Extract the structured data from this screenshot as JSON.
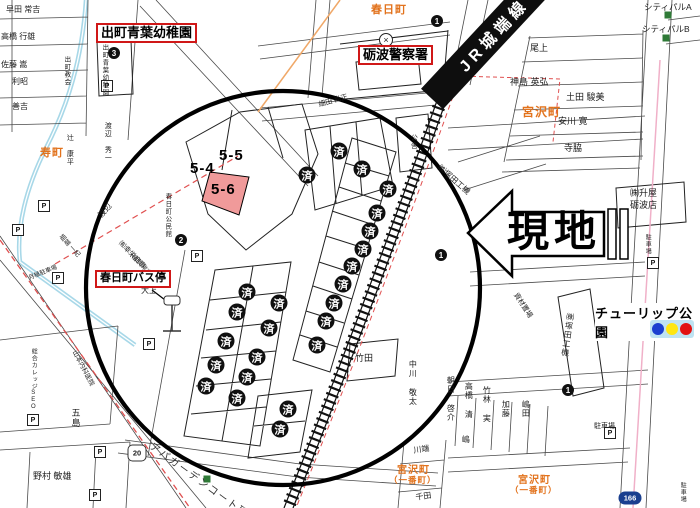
{
  "map": {
    "site_label": "現地",
    "railway_label": "JR城端線",
    "park_label": "チューリップ公園",
    "apartment_label": "アパガーデンコート砺波",
    "sold_label": "済",
    "police_symbol": "×",
    "parking_symbol": "P",
    "colors": {
      "red_box_border": "#d01818",
      "town_orange": "#e2721c",
      "pink_lot": "#f09a9a",
      "signal_bg": "#bfe3f2",
      "signal_lights": [
        "#1b3fd0",
        "#ffe612",
        "#e21212"
      ],
      "green_square": "#2f7a37",
      "canal_blue": "#a8d8e8",
      "route_dash_red": "#e05050"
    },
    "red_box_labels": [
      {
        "text": "出町青葉幼稚園",
        "x": 96,
        "y": 23,
        "fs": 13
      },
      {
        "text": "砺波警察署",
        "x": 358,
        "y": 45,
        "fs": 13
      },
      {
        "text": "春日町バス停",
        "x": 95,
        "y": 270,
        "fs": 11
      }
    ],
    "town_labels": [
      {
        "text": "春日町",
        "x": 371,
        "y": 1,
        "fs": 11
      },
      {
        "text": "寿町",
        "x": 40,
        "y": 144,
        "fs": 11
      },
      {
        "text": "宮沢町",
        "x": 522,
        "y": 103,
        "fs": 12
      },
      {
        "text": "宮沢町",
        "x": 397,
        "y": 461,
        "fs": 10
      },
      {
        "text": "（一番町）",
        "x": 389,
        "y": 474,
        "fs": 8.5
      },
      {
        "text": "宮沢町",
        "x": 518,
        "y": 471,
        "fs": 10
      },
      {
        "text": "（一番町）",
        "x": 510,
        "y": 484,
        "fs": 8.5
      }
    ],
    "lot_labels": [
      {
        "text": "5-4",
        "x": 190,
        "y": 160
      },
      {
        "text": "5-5",
        "x": 219,
        "y": 147
      },
      {
        "text": "5-6",
        "x": 211,
        "y": 181
      }
    ],
    "sold_markers": [
      [
        307,
        175
      ],
      [
        339,
        151
      ],
      [
        362,
        169
      ],
      [
        388,
        189
      ],
      [
        377,
        213
      ],
      [
        370,
        231
      ],
      [
        363,
        249
      ],
      [
        352,
        266
      ],
      [
        343,
        284
      ],
      [
        334,
        303
      ],
      [
        326,
        321
      ],
      [
        317,
        345
      ],
      [
        247,
        292
      ],
      [
        279,
        303
      ],
      [
        237,
        312
      ],
      [
        269,
        328
      ],
      [
        226,
        341
      ],
      [
        257,
        357
      ],
      [
        216,
        365
      ],
      [
        247,
        377
      ],
      [
        206,
        386
      ],
      [
        237,
        398
      ],
      [
        288,
        409
      ],
      [
        280,
        429
      ]
    ],
    "numbered_markers": [
      {
        "n": "1",
        "x": 437,
        "y": 21
      },
      {
        "n": "3",
        "x": 114,
        "y": 53
      },
      {
        "n": "2",
        "x": 181,
        "y": 240
      },
      {
        "n": "1",
        "x": 441,
        "y": 255
      },
      {
        "n": "1",
        "x": 568,
        "y": 390
      }
    ],
    "parking_icons": [
      [
        107,
        86
      ],
      [
        44,
        206
      ],
      [
        18,
        230
      ],
      [
        58,
        278
      ],
      [
        197,
        256
      ],
      [
        149,
        344
      ],
      [
        33,
        420
      ],
      [
        100,
        452
      ],
      [
        95,
        495
      ],
      [
        653,
        263
      ],
      [
        610,
        433
      ]
    ],
    "green_squares": [
      [
        668,
        15
      ],
      [
        666,
        38
      ],
      [
        207,
        479
      ]
    ],
    "route_badges": [
      {
        "label": "20",
        "x": 137,
        "y": 453,
        "shape": "hex"
      },
      {
        "label": "166",
        "x": 630,
        "y": 498,
        "shape": "oval"
      }
    ],
    "small_labels": [
      {
        "text": "早田 常吉",
        "x": 6,
        "y": 6,
        "fs": 8
      },
      {
        "text": "高橋 行雄",
        "x": 1,
        "y": 33,
        "fs": 8
      },
      {
        "text": "佐藤 嵩",
        "x": 1,
        "y": 61,
        "fs": 8
      },
      {
        "text": "利昭",
        "x": 12,
        "y": 78,
        "fs": 8
      },
      {
        "text": "善吉",
        "x": 12,
        "y": 103,
        "fs": 8
      },
      {
        "text": "出町青葉幼稚園",
        "x": 100,
        "y": 44,
        "fs": 6.5,
        "vert": 1
      },
      {
        "text": "出町教会",
        "x": 62,
        "y": 56,
        "fs": 6.5,
        "vert": 1
      },
      {
        "text": "辻 康平",
        "x": 66,
        "y": 134,
        "fs": 7,
        "vert": 1
      },
      {
        "text": "渡辺 秀一",
        "x": 104,
        "y": 122,
        "fs": 7,
        "vert": 1
      },
      {
        "text": "渡辺",
        "x": 97,
        "y": 214,
        "fs": 8,
        "rot": -48
      },
      {
        "text": "堀端 一紀",
        "x": 62,
        "y": 234,
        "fs": 6.5,
        "rot": 48
      },
      {
        "text": "春日町公民館",
        "x": 163,
        "y": 193,
        "fs": 6.5,
        "vert": 1
      },
      {
        "text": "㈲幸栄商事",
        "x": 122,
        "y": 240,
        "fs": 7,
        "rot": 46
      },
      {
        "text": "（稲原 常吉）",
        "x": 130,
        "y": 250,
        "fs": 6,
        "rot": 46
      },
      {
        "text": "大上",
        "x": 141,
        "y": 287,
        "fs": 8
      },
      {
        "text": "月極駐車場",
        "x": 28,
        "y": 276,
        "fs": 6,
        "rot": -22
      },
      {
        "text": "山本内科医院",
        "x": 76,
        "y": 350,
        "fs": 6.5,
        "rot": 62
      },
      {
        "text": "総合カレッジSEO",
        "x": 30,
        "y": 348,
        "fs": 6,
        "vert": 1
      },
      {
        "text": "五島",
        "x": 70,
        "y": 408,
        "fs": 9,
        "vert": 1
      },
      {
        "text": "野村 敏雄",
        "x": 33,
        "y": 472,
        "fs": 9
      },
      {
        "text": "尾上",
        "x": 530,
        "y": 44,
        "fs": 9
      },
      {
        "text": "神島 英弘",
        "x": 510,
        "y": 78,
        "fs": 9
      },
      {
        "text": "土田 駿美",
        "x": 566,
        "y": 93,
        "fs": 9
      },
      {
        "text": "安川 寛",
        "x": 558,
        "y": 117,
        "fs": 9
      },
      {
        "text": "寺脇",
        "x": 564,
        "y": 144,
        "fs": 9
      },
      {
        "text": "シティパルA",
        "x": 644,
        "y": 3,
        "fs": 8.5
      },
      {
        "text": "シティパルB",
        "x": 642,
        "y": 25,
        "fs": 8.5
      },
      {
        "text": "細田 尚正",
        "x": 318,
        "y": 102,
        "fs": 7,
        "rot": -16
      },
      {
        "text": "公舎",
        "x": 410,
        "y": 134,
        "fs": 7,
        "vert": 1
      },
      {
        "text": "竹田",
        "x": 355,
        "y": 354,
        "fs": 9
      },
      {
        "text": "中川 敬太",
        "x": 408,
        "y": 360,
        "fs": 8,
        "vert": 1
      },
      {
        "text": "朝日 啓介",
        "x": 446,
        "y": 376,
        "fs": 8,
        "vert": 1
      },
      {
        "text": "高橋 清",
        "x": 464,
        "y": 382,
        "fs": 8,
        "vert": 1
      },
      {
        "text": "竹林 実",
        "x": 482,
        "y": 386,
        "fs": 8,
        "vert": 1
      },
      {
        "text": "加藤",
        "x": 501,
        "y": 400,
        "fs": 8,
        "vert": 1
      },
      {
        "text": "嶋田",
        "x": 521,
        "y": 400,
        "fs": 8,
        "vert": 1
      },
      {
        "text": "嶋",
        "x": 461,
        "y": 435,
        "fs": 8,
        "vert": 1
      },
      {
        "text": "川端",
        "x": 413,
        "y": 447,
        "fs": 8,
        "rot": -8
      },
      {
        "text": "千田",
        "x": 415,
        "y": 494,
        "fs": 8,
        "rot": -8
      },
      {
        "text": "㈱塚田工機",
        "x": 441,
        "y": 164,
        "fs": 8,
        "rot": 41
      },
      {
        "text": "㈱塚田工機",
        "x": 566,
        "y": 312,
        "fs": 8,
        "vert": 1,
        "rot": 8
      },
      {
        "text": "㈱升屋",
        "x": 630,
        "y": 189,
        "fs": 9
      },
      {
        "text": "砺波店",
        "x": 630,
        "y": 201,
        "fs": 9
      },
      {
        "text": "資材置場",
        "x": 518,
        "y": 292,
        "fs": 7,
        "rot": 57
      },
      {
        "text": "駐車場",
        "x": 644,
        "y": 234,
        "fs": 6,
        "vert": 1
      },
      {
        "text": "駐車場",
        "x": 594,
        "y": 423,
        "fs": 7
      },
      {
        "text": "駐車場",
        "x": 679,
        "y": 482,
        "fs": 6,
        "vert": 1
      }
    ]
  }
}
